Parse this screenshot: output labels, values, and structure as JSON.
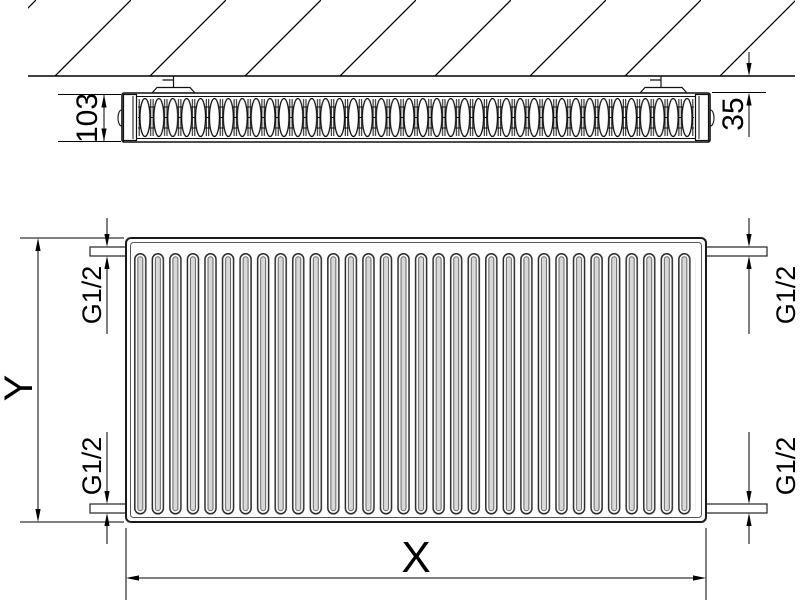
{
  "diagram": {
    "top_view": {
      "depth_label": "103",
      "wall_gap_label": "35"
    },
    "front_view": {
      "height_label": "Y",
      "width_label": "X",
      "connections": {
        "top_left": "G1/2",
        "bottom_left": "G1/2",
        "top_right": "G1/2",
        "bottom_right": "G1/2"
      }
    },
    "colors": {
      "line": "#000000",
      "background": "#ffffff",
      "fin_fill": "#d8d8d8"
    }
  }
}
